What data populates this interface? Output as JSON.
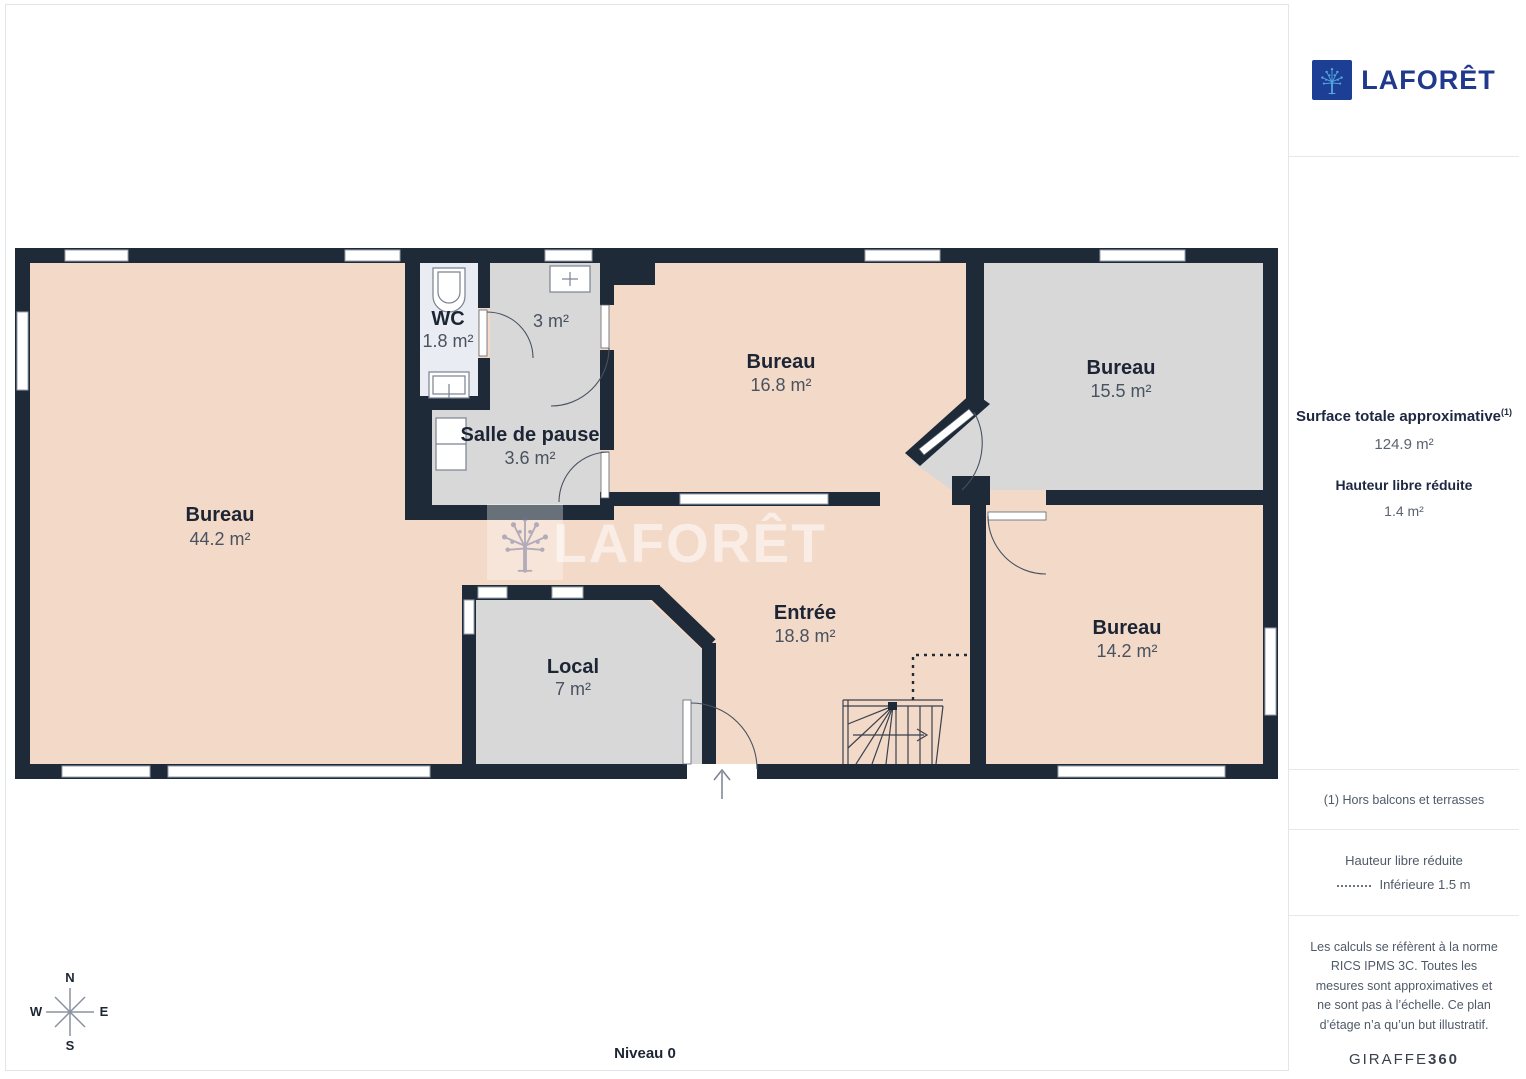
{
  "brand": {
    "name": "LAFORÊT"
  },
  "watermark": {
    "text": "LAFORÊT"
  },
  "sidebar": {
    "surface_label": "Surface totale approximative",
    "surface_sup": "(1)",
    "surface_value": "124.9 m²",
    "height_label": "Hauteur libre réduite",
    "height_value": "1.4 m²",
    "footnote": "(1) Hors balcons et terrasses",
    "legend_title": "Hauteur libre réduite",
    "legend_item": "Inférieure 1.5 m",
    "disclaimer": "Les calculs se réfèrent à la norme RICS IPMS 3C. Toutes les mesures sont approximatives et ne sont pas à l’échelle. Ce plan d’étage n’a qu’un but illustratif.",
    "credit_regular": "GIRAFFE",
    "credit_bold": "360"
  },
  "plan": {
    "level_label": "Niveau 0",
    "compass": {
      "n": "N",
      "s": "S",
      "e": "E",
      "w": "W"
    },
    "rooms": [
      {
        "name": "Bureau",
        "area": "44.2 m²"
      },
      {
        "name": "WC",
        "area": "1.8 m²"
      },
      {
        "name": "",
        "area": "3 m²"
      },
      {
        "name": "Salle de pause",
        "area": "3.6 m²"
      },
      {
        "name": "Bureau",
        "area": "16.8 m²"
      },
      {
        "name": "Bureau",
        "area": "15.5 m²"
      },
      {
        "name": "Entrée",
        "area": "18.8 m²"
      },
      {
        "name": "Local",
        "area": "7 m²"
      },
      {
        "name": "Bureau",
        "area": "14.2 m²"
      }
    ],
    "colors": {
      "wall": "#1e2a38",
      "room_salmon": "#f3d9c8",
      "room_gray": "#d8d8d9",
      "room_light": "#e9edf3",
      "brand_blue": "#1c3e95",
      "brand_text": "#21398c"
    }
  }
}
